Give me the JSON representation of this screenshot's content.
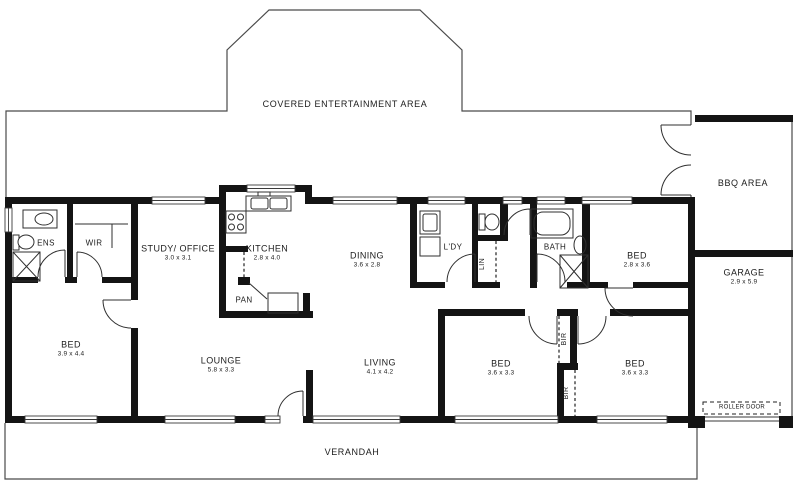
{
  "plan": {
    "type": "residential floor plan",
    "colors": {
      "wall": "#141414",
      "thin_line": "#4a4a4a",
      "text": "#1c1c1c",
      "background": "#ffffff"
    },
    "outdoor": {
      "entertainment": "COVERED ENTERTAINMENT AREA",
      "bbq": "BBQ AREA",
      "verandah": "VERANDAH",
      "roller_door": "ROLLER DOOR"
    },
    "rooms": {
      "ens": {
        "name": "ENS"
      },
      "wir": {
        "name": "WIR"
      },
      "study": {
        "name": "STUDY/ OFFICE",
        "dims": "3.0 x 3.1"
      },
      "kitchen": {
        "name": "KITCHEN",
        "dims": "2.8 x 4.0"
      },
      "pan": {
        "name": "PAN"
      },
      "dining": {
        "name": "DINING",
        "dims": "3.6 x 2.8"
      },
      "laundry": {
        "name": "L'DY"
      },
      "linen": {
        "name": "LIN"
      },
      "bath": {
        "name": "BATH"
      },
      "bed_right": {
        "name": "BED",
        "dims": "2.8 x 3.6"
      },
      "bed_master": {
        "name": "BED",
        "dims": "3.9 x 4.4"
      },
      "lounge": {
        "name": "LOUNGE",
        "dims": "5.8 x 3.3"
      },
      "living": {
        "name": "LIVING",
        "dims": "4.1 x 4.2"
      },
      "bed_three": {
        "name": "BED",
        "dims": "3.6 x 3.3"
      },
      "bed_four": {
        "name": "BED",
        "dims": "3.6 x 3.3"
      },
      "bir_top": {
        "name": "BIR"
      },
      "bir_bottom": {
        "name": "BIR"
      },
      "garage": {
        "name": "GARAGE",
        "dims": "2.9 x 5.9"
      }
    }
  }
}
